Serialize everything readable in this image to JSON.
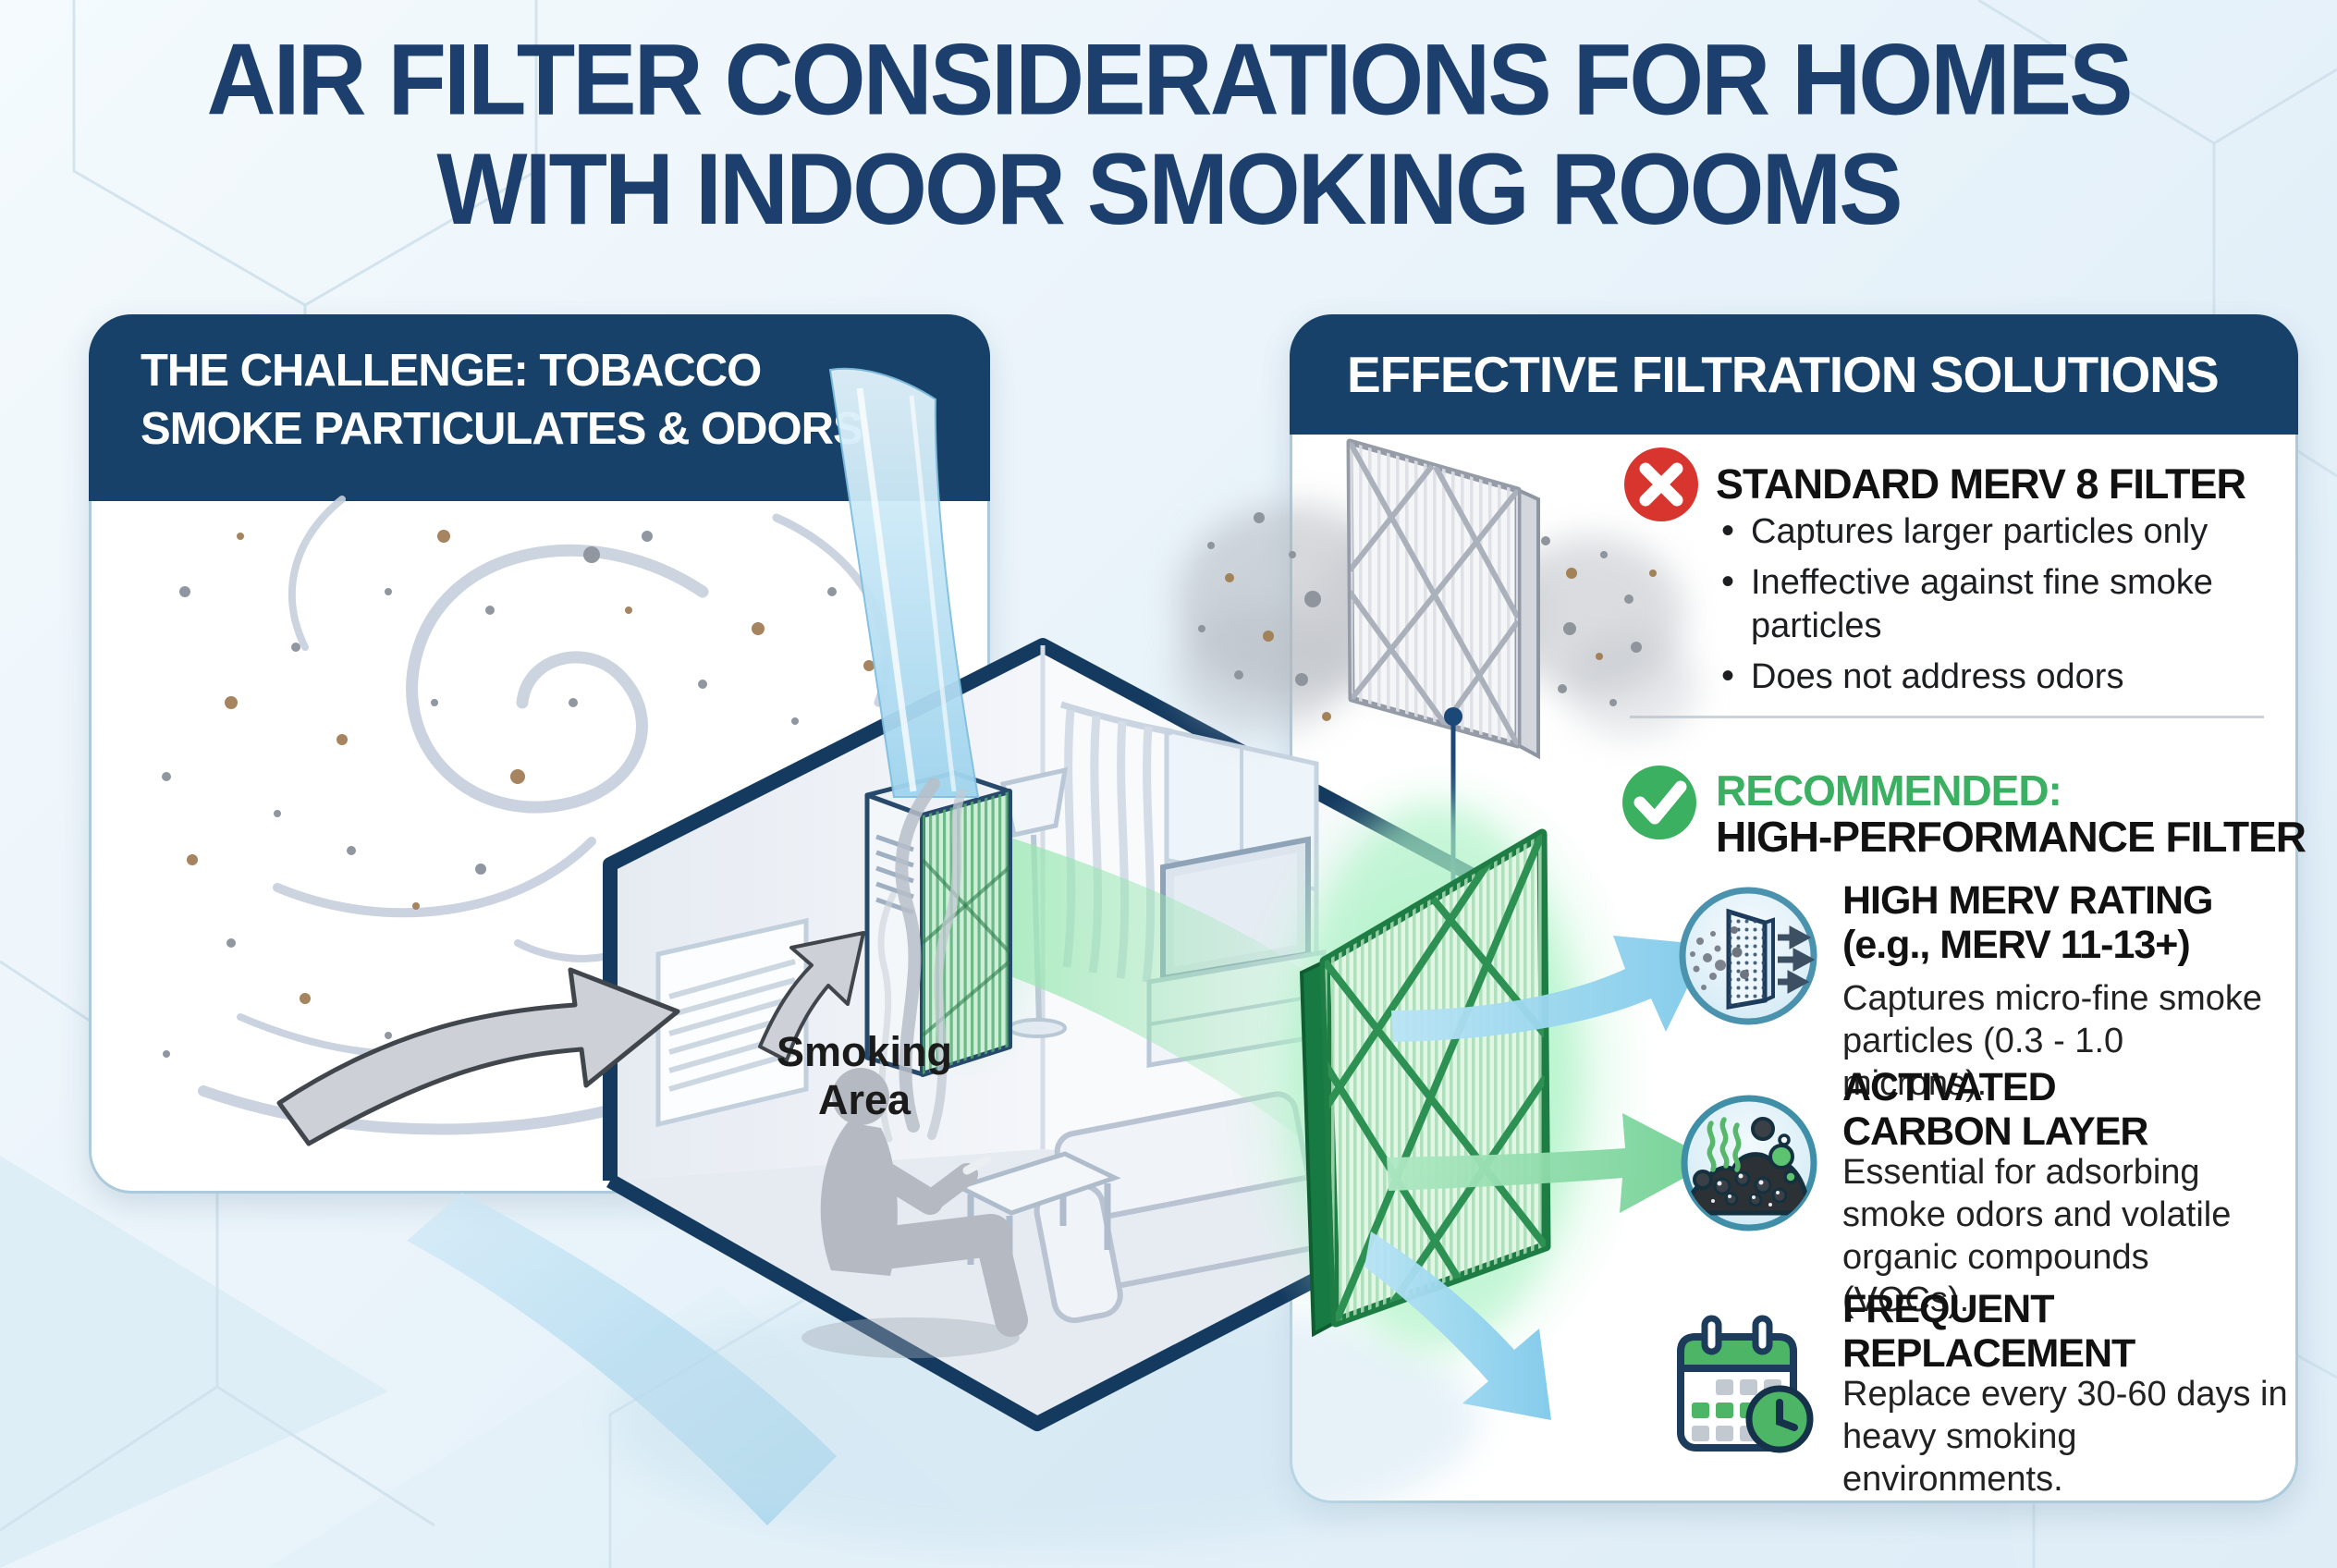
{
  "title": {
    "line1": "AIR FILTER CONSIDERATIONS FOR HOMES",
    "line2": "WITH INDOOR SMOKING ROOMS"
  },
  "challenge_panel": {
    "header_line1": "THE CHALLENGE: TOBACCO",
    "header_line2": "SMOKE PARTICULATES & ODORS"
  },
  "room": {
    "smoking_label_line1": "Smoking",
    "smoking_label_line2": "Area"
  },
  "solutions_panel": {
    "header": "EFFECTIVE FILTRATION SOLUTIONS",
    "standard_filter": {
      "icon": "x-circle-icon",
      "title": "STANDARD MERV 8 FILTER",
      "bullets": [
        "Captures larger particles only",
        "Ineffective against fine smoke particles",
        "Does not address odors"
      ]
    },
    "recommended": {
      "icon": "check-circle-icon",
      "label": "RECOMMENDED:",
      "title": "HIGH-PERFORMANCE FILTER"
    },
    "features": [
      {
        "icon": "merv-filter-icon",
        "title_line1": "HIGH MERV RATING",
        "title_line2": "(e.g., MERV 11-13+)",
        "body": "Captures micro-fine smoke particles (0.3 - 1.0 microns)."
      },
      {
        "icon": "activated-carbon-icon",
        "title_line1": "ACTIVATED",
        "title_line2": "CARBON LAYER",
        "body": "Essential for adsorbing smoke odors and volatile organic compounds (VOCs)."
      },
      {
        "icon": "calendar-clock-icon",
        "title_line1": "FREQUENT",
        "title_line2": "REPLACEMENT",
        "body": "Replace every 30-60 days in heavy smoking environments."
      }
    ]
  },
  "colors": {
    "navy_header": "#174169",
    "title_navy": "#1d3f6d",
    "green_accent": "#3bb062",
    "red_accent": "#d8352f",
    "filter_green_frame": "#1e7d44",
    "arrow_blue": "#8ed0ec",
    "arrow_green": "#7fd49c",
    "background": "#e9f3fa"
  }
}
